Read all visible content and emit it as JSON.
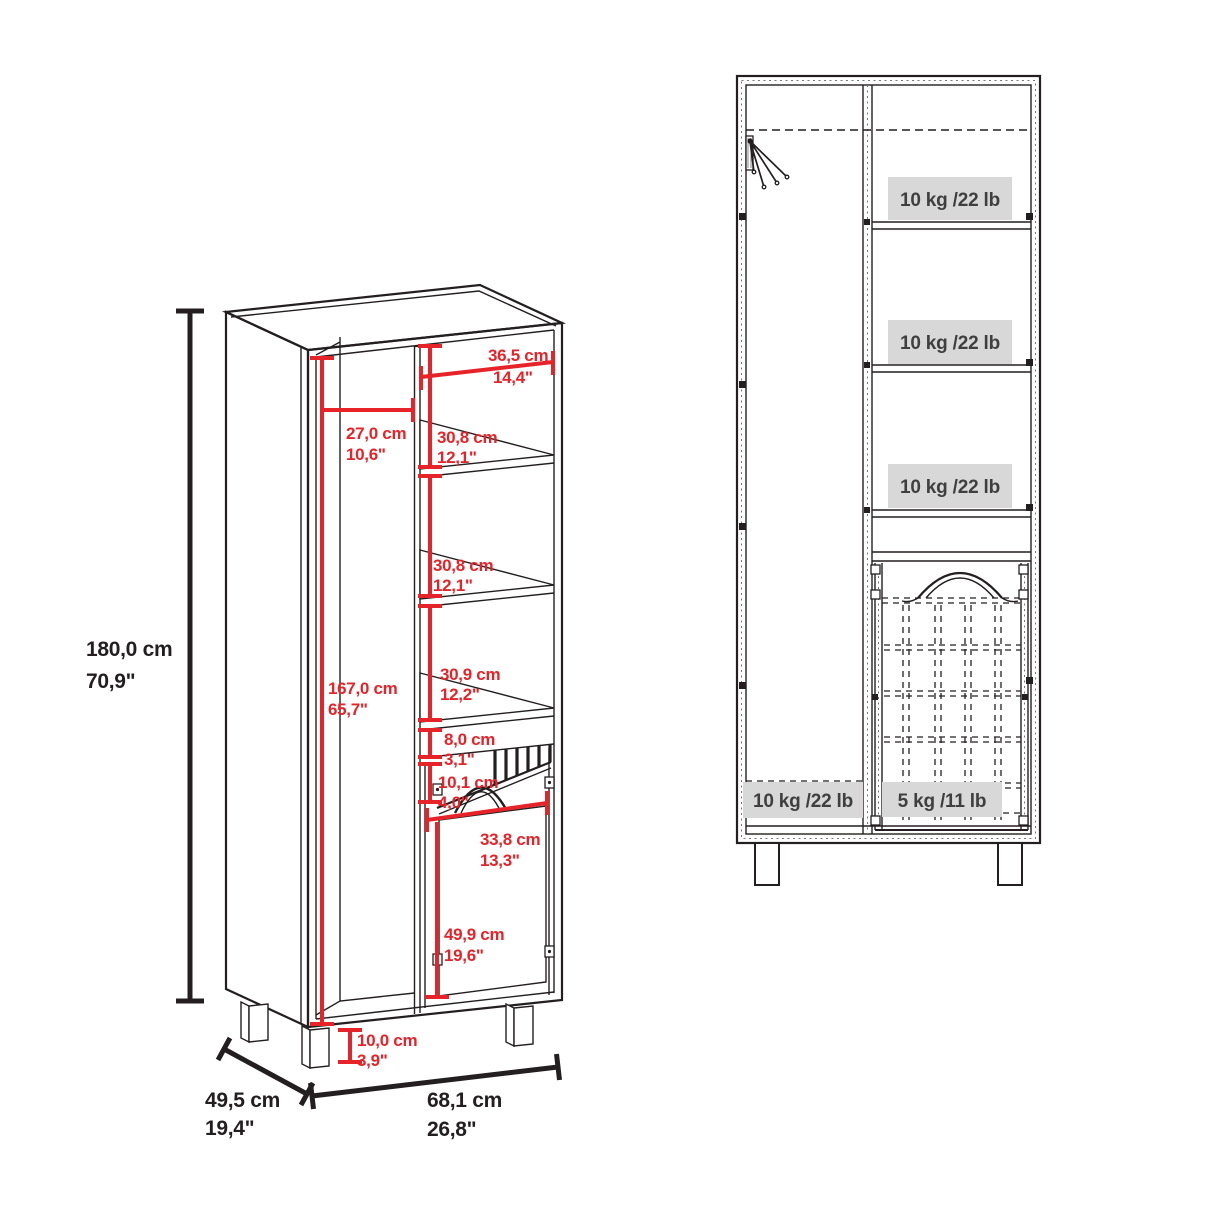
{
  "colors": {
    "bg": "#ffffff",
    "line": "#231f20",
    "dim_red": "#e62329",
    "label_bg": "#d8d8d8",
    "label_text": "#3f3f3f"
  },
  "perspective_view": {
    "total_height": {
      "cm": "180,0 cm",
      "inch": "70,9\""
    },
    "interior_height": {
      "cm": "167,0 cm",
      "inch": "65,7\""
    },
    "left_compartment_width": {
      "cm": "27,0 cm",
      "inch": "10,6\""
    },
    "right_compartment_width": {
      "cm": "36,5 cm",
      "inch": "14,4\""
    },
    "top_shelf_spacing": {
      "cm": "30,8 cm",
      "inch": "12,1\""
    },
    "middle_shelf_spacing": {
      "cm": "30,8 cm",
      "inch": "12,1\""
    },
    "bottom_shelf_spacing": {
      "cm": "30,9 cm",
      "inch": "12,2\""
    },
    "drawer_front_height": {
      "cm": "8,0 cm",
      "inch": "3,1\""
    },
    "vent_height": {
      "cm": "10,1 cm",
      "inch": "4,0\""
    },
    "door_width": {
      "cm": "33,8 cm",
      "inch": "13,3\""
    },
    "door_height": {
      "cm": "49,9 cm",
      "inch": "19,6\""
    },
    "leg_height": {
      "cm": "10,0 cm",
      "inch": "3,9\""
    },
    "depth": {
      "cm": "49,5 cm",
      "inch": "19,4\""
    },
    "width": {
      "cm": "68,1 cm",
      "inch": "26,8\""
    }
  },
  "front_view": {
    "top_shelf_capacity": "10 kg /22 lb",
    "middle_shelf_capacity": "10 kg /22 lb",
    "bottom_shelf_capacity": "10 kg /22 lb",
    "left_compartment_capacity": "10 kg /22 lb",
    "basket_capacity": "5 kg /11 lb"
  }
}
